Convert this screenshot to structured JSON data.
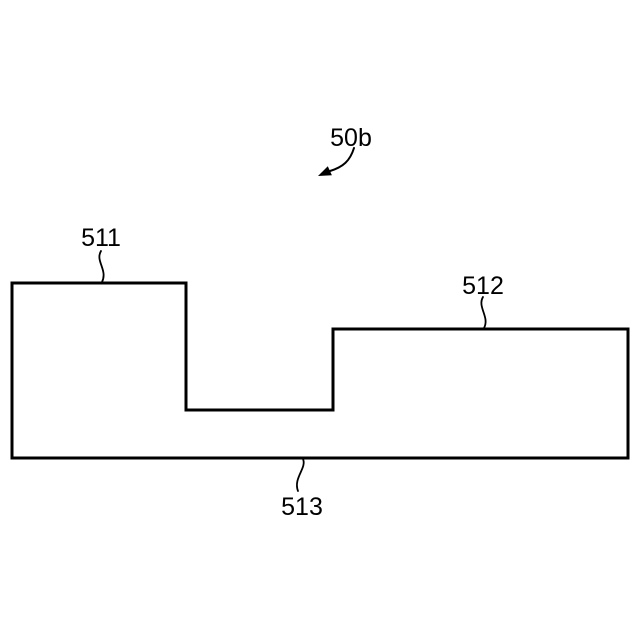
{
  "figure": {
    "reference_label": "50b",
    "part_labels": {
      "left": "511",
      "right": "512",
      "base": "513"
    },
    "colors": {
      "line": "#000000",
      "background": "#ffffff"
    }
  }
}
